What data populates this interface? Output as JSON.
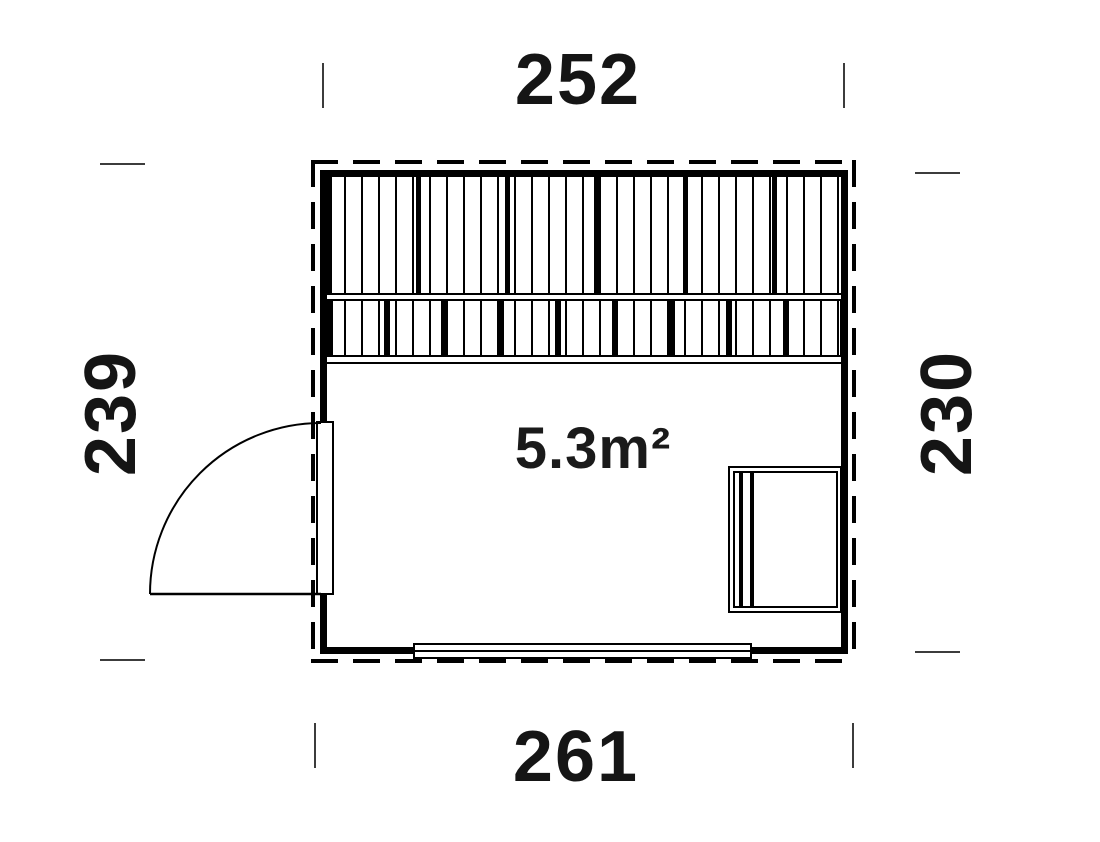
{
  "plan": {
    "area_label": "5.3m²",
    "dimensions": {
      "top": "252",
      "bottom": "261",
      "left": "239",
      "right": "230"
    },
    "colors": {
      "line": "#000000",
      "tick": "#3c3c3c",
      "background": "#ffffff"
    },
    "features": {
      "bench": "slatted-bench-area",
      "door": "left-hinged-door-90deg-swing",
      "window": "bottom-window",
      "table": "right-wall-table"
    }
  }
}
